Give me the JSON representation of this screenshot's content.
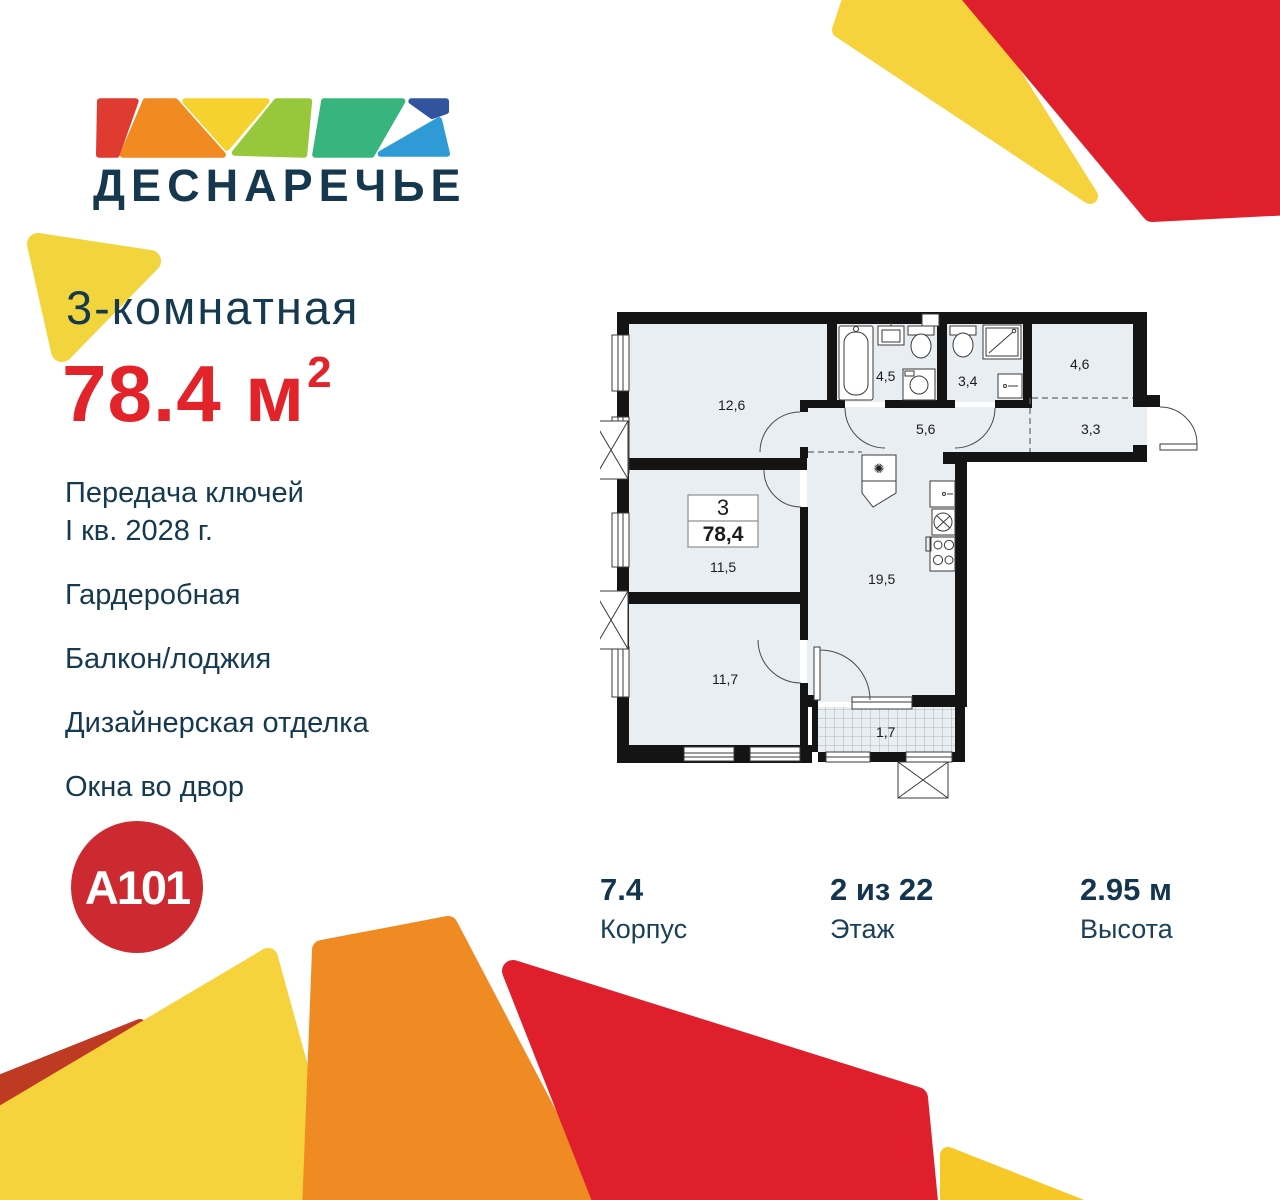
{
  "brand": {
    "logo_text": "ДЕСНАРЕЧЬЕ",
    "developer_logo": "A101"
  },
  "listing": {
    "title": "3-комнатная",
    "area": "78.4",
    "area_unit": "м",
    "area_superscript": "2",
    "features": [
      {
        "lines": [
          "Передача ключей",
          "I кв. 2028 г."
        ]
      },
      {
        "lines": [
          "Гардеробная"
        ]
      },
      {
        "lines": [
          "Балкон/лоджия"
        ]
      },
      {
        "lines": [
          "Дизайнерская отделка"
        ]
      },
      {
        "lines": [
          "Окна во двор"
        ]
      }
    ]
  },
  "specs": [
    {
      "value": "7.4",
      "label": "Корпус"
    },
    {
      "value": "2 из 22",
      "label": "Этаж"
    },
    {
      "value": "2.95 м",
      "label": "Высота"
    }
  ],
  "floorplan": {
    "unit_rooms": "3",
    "unit_area": "78,4",
    "room_labels": [
      {
        "name": "bedroom-1",
        "area": "12,6"
      },
      {
        "name": "bathroom",
        "area": "4,5"
      },
      {
        "name": "wc",
        "area": "3,4"
      },
      {
        "name": "wardrobe",
        "area": "4,6"
      },
      {
        "name": "hallway",
        "area": "5,6"
      },
      {
        "name": "entry-hall",
        "area": "3,3"
      },
      {
        "name": "bedroom-2",
        "area": "11,5"
      },
      {
        "name": "kitchen-living",
        "area": "19,5"
      },
      {
        "name": "bedroom-3",
        "area": "11,7"
      },
      {
        "name": "balcony",
        "area": "1,7"
      }
    ]
  },
  "colors": {
    "navy_text": "#16394F",
    "accent_red": "#E2232A",
    "a101_red": "#CC2A30",
    "logo_red": "#E03B30",
    "logo_orange": "#F08A21",
    "logo_yellow": "#F6D22E",
    "logo_lightgreen": "#97C83C",
    "logo_green": "#38B57C",
    "logo_darkblue": "#32549E",
    "logo_lightblue": "#2E9BD6",
    "deco_yellow": "#F6D33C",
    "deco_orange": "#EF8B22",
    "deco_red": "#E01F2D",
    "deco_brick": "#BF3A22",
    "plan_floor": "#E9EEF2",
    "plan_wall": "#141414"
  }
}
